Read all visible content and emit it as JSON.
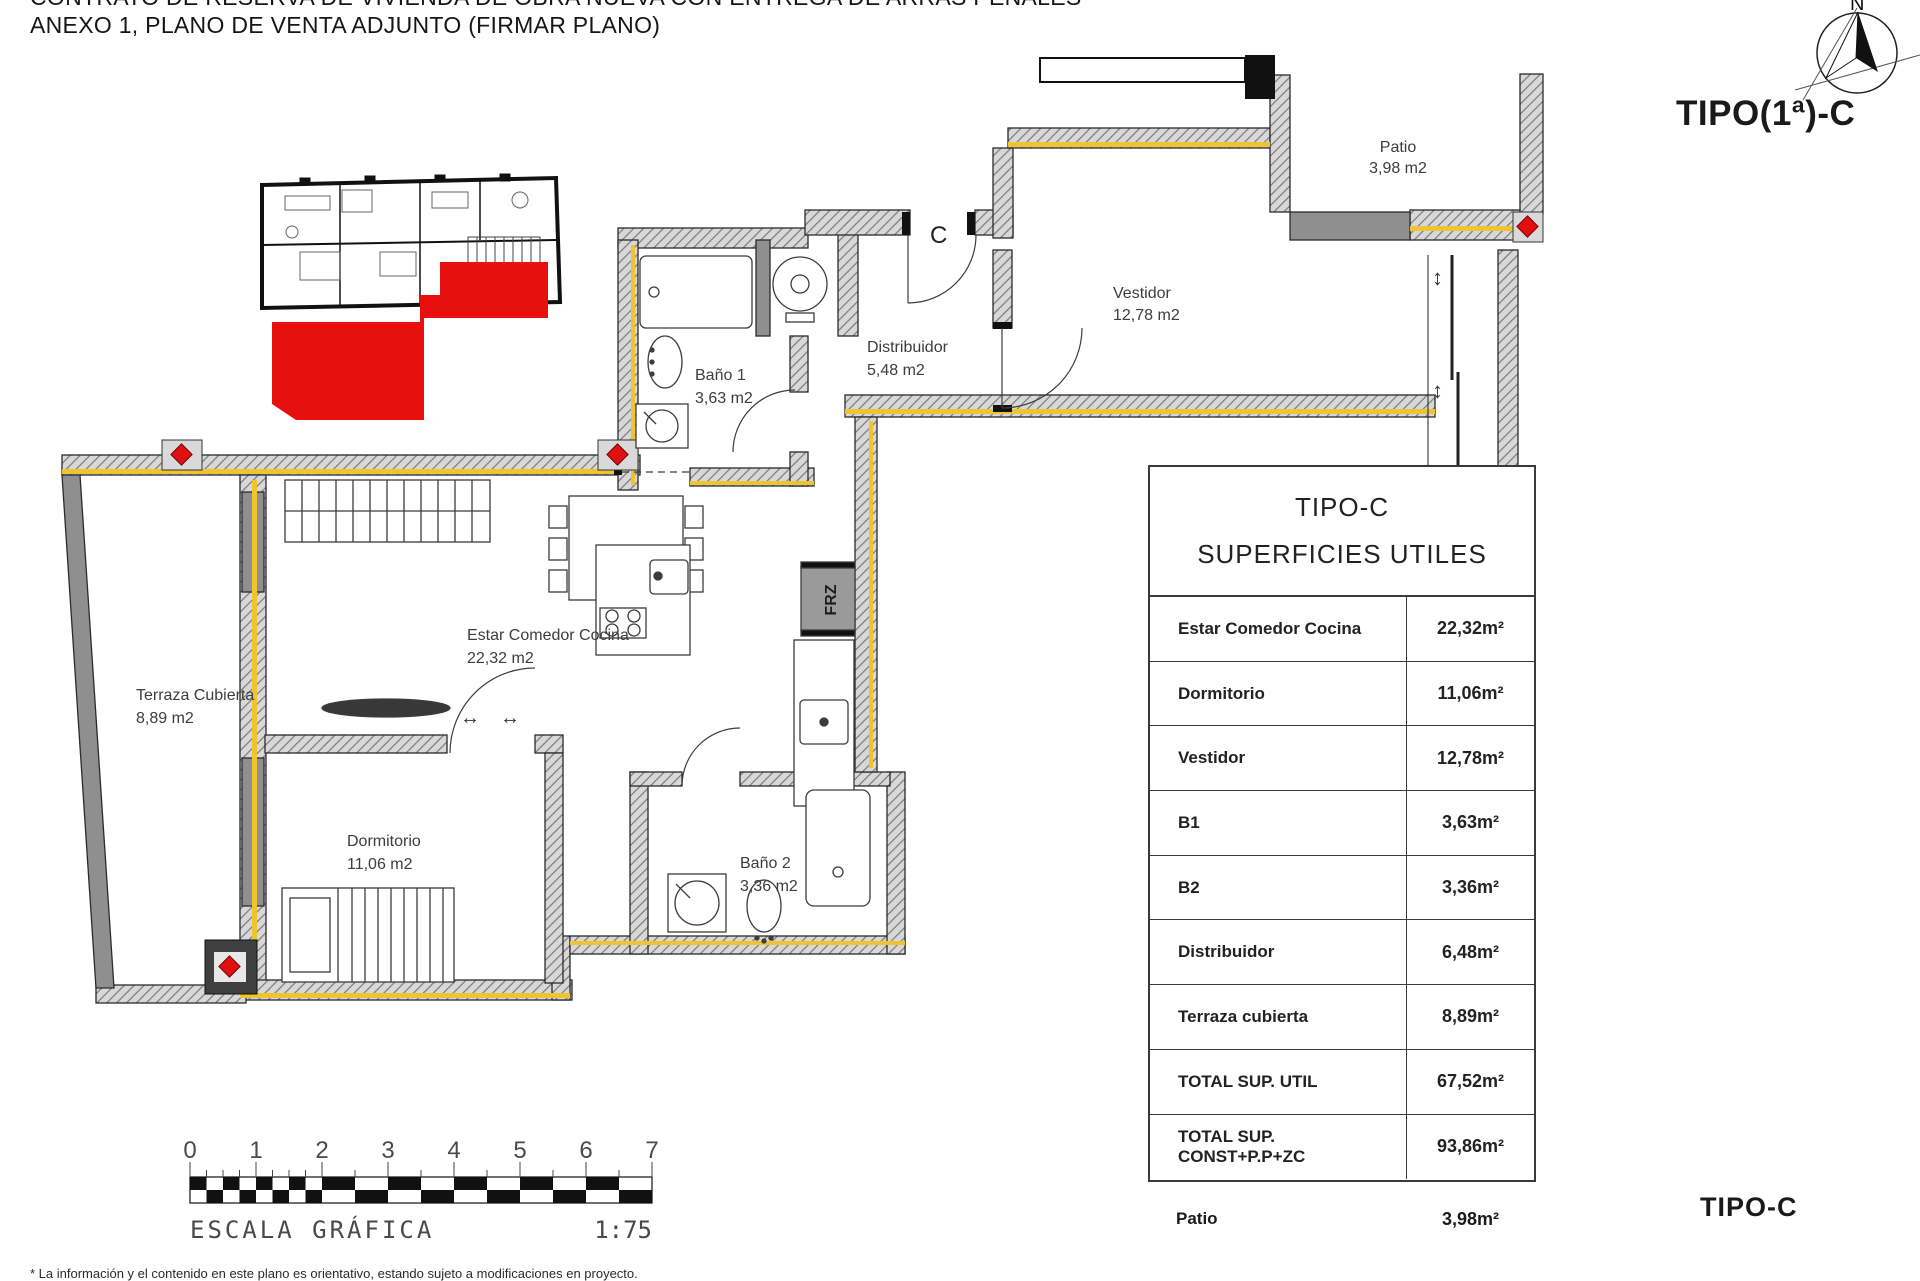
{
  "header": {
    "line1": "CONTRATO DE RESERVA DE VIVIENDA DE OBRA NUEVA CON ENTREGA DE ARRAS PENALES",
    "line2": "ANEXO 1, PLANO DE VENTA ADJUNTO (FIRMAR PLANO)"
  },
  "compass": {
    "north_label": "N"
  },
  "type_label_top": "TIPO(1ª)-C",
  "type_label_bottom": "TIPO-C",
  "plan": {
    "rooms": [
      {
        "name": "Patio",
        "area": "3,98 m2"
      },
      {
        "name": "Vestidor",
        "area": "12,78 m2"
      },
      {
        "name": "Distribuidor",
        "area": "5,48 m2"
      },
      {
        "name": "Baño 1",
        "area": "3,63 m2"
      },
      {
        "name": "Estar Comedor Cocina",
        "area": "22,32 m2"
      },
      {
        "name": "Terraza Cubierta",
        "area": "8,89 m2"
      },
      {
        "name": "Dormitorio",
        "area": "11,06 m2"
      },
      {
        "name": "Baño 2",
        "area": "3,36 m2"
      }
    ],
    "entry_door_label": "C",
    "appliance_label": "FRZ"
  },
  "table": {
    "title1": "TIPO-C",
    "title2": "SUPERFICIES UTILES",
    "rows": [
      {
        "label": "Estar Comedor Cocina",
        "value": "22,32m²"
      },
      {
        "label": "Dormitorio",
        "value": "11,06m²"
      },
      {
        "label": "Vestidor",
        "value": "12,78m²"
      },
      {
        "label": "B1",
        "value": "3,63m²"
      },
      {
        "label": "B2",
        "value": "3,36m²"
      },
      {
        "label": "Distribuidor",
        "value": "6,48m²"
      },
      {
        "label": "Terraza cubierta",
        "value": "8,89m²"
      },
      {
        "label": "TOTAL SUP. UTIL",
        "value": "67,52m²"
      },
      {
        "label": "TOTAL SUP. CONST+P.P+ZC",
        "value": "93,86m²"
      }
    ],
    "extra_row": {
      "label": "Patio",
      "value": "3,98m²"
    }
  },
  "scale": {
    "ticks": [
      "0",
      "1",
      "2",
      "3",
      "4",
      "5",
      "6",
      "7"
    ],
    "label": "ESCALA GRÁFICA",
    "ratio": "1:75"
  },
  "footnote": "* La información y el contenido en este plano es orientativo, estando sujeto a modificaciones en proyecto.",
  "colors": {
    "highlight": "#e80f0f",
    "insulation": "#f0c330",
    "marker": "#e01010"
  }
}
